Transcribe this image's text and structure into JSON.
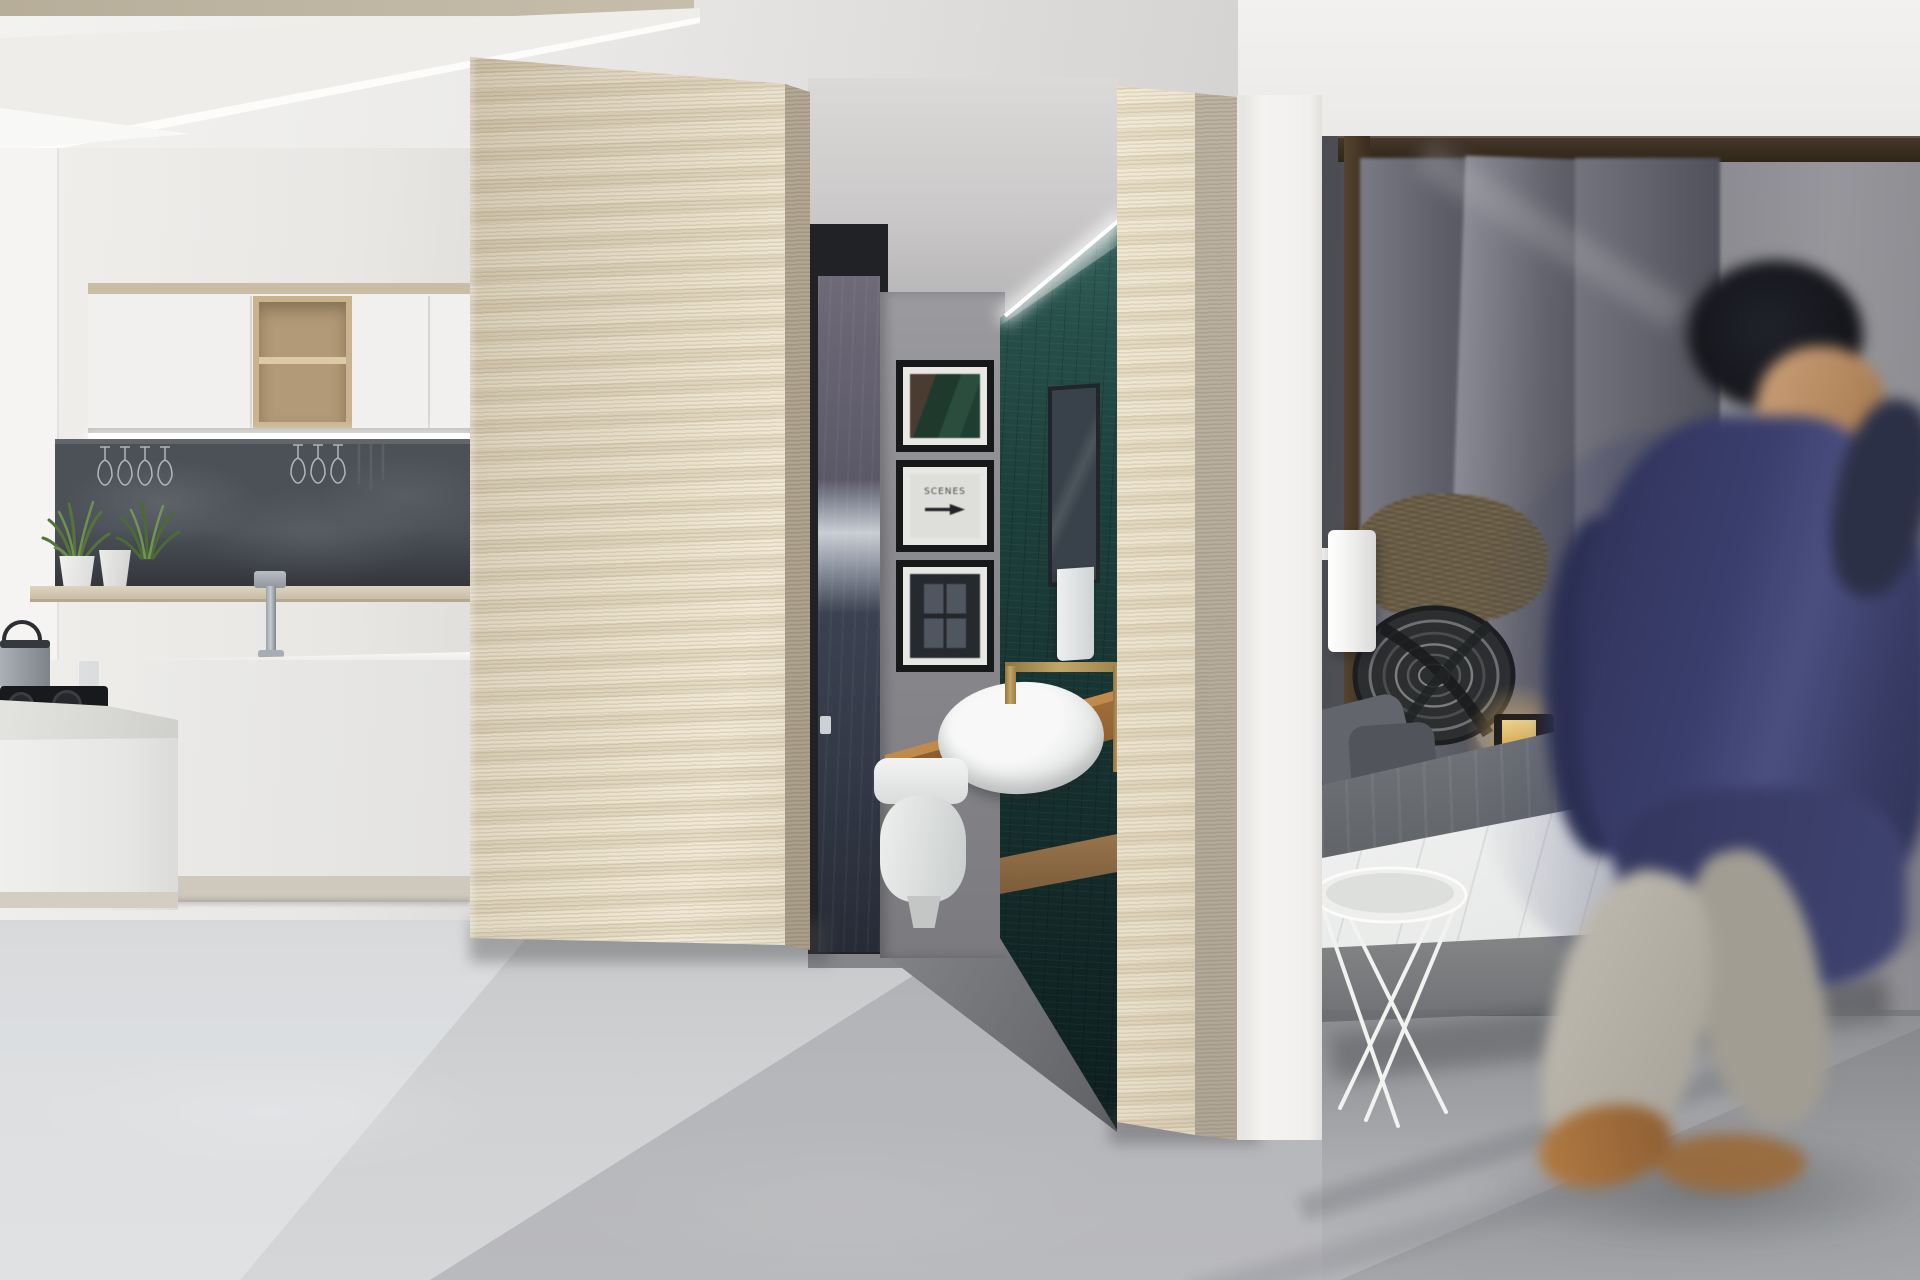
{
  "scene": {
    "title": "Studio apartment interior render",
    "style": "photorealistic 3D architectural visualization",
    "regions": [
      "kitchen",
      "travertine partition column",
      "bathroom niche",
      "second partition column",
      "bedroom",
      "walking person"
    ]
  },
  "kitchen": {
    "upper_cabinets": "white flat-front cabinets with open oak cube shelf",
    "backsplash": "dark slate niche with hanging stemware and LED under-cabinet light",
    "items": [
      "potted plant in white pot",
      "potted plant in white pot",
      "chrome faucet",
      "gas cooktop",
      "steel pot with lid",
      "glass tumbler",
      "white island",
      "white counter run"
    ]
  },
  "bathroom": {
    "artworks": [
      {
        "name": "framed-art-landscape",
        "desc": "dark green abstract landscape print",
        "text": ""
      },
      {
        "name": "framed-art-typographic",
        "text": "SCENES",
        "desc": "white print with black right arrow"
      },
      {
        "name": "framed-art-window",
        "desc": "dark window scene print",
        "text": ""
      }
    ],
    "fixtures": [
      "white round vessel sink",
      "brass square-arch faucet",
      "oak floating counter",
      "white toilet",
      "tiled mirror",
      "white hand towel",
      "dark glass door with chrome handle"
    ],
    "feature_wall": "dark teal mosaic tile with LED cove lighting"
  },
  "bedroom": {
    "furniture": [
      "dark wood four-poster frame",
      "gray drapes",
      "rattan headboard tray",
      "fur cushion",
      "white cylinder wall sconce",
      "glowing lantern candle",
      "white wire side table",
      "gray upholstered platform bed",
      "rounded gray footboard"
    ],
    "bedding": [
      "white duvet",
      "gray throw blanket",
      "dark gray pillows",
      "gray side pillow"
    ]
  },
  "person": {
    "desc": "motion-blurred man walking right while holding phone to ear",
    "clothing": {
      "jacket": "navy blue",
      "trousers": "light beige",
      "shoes": "tan"
    }
  },
  "palette": {
    "ceiling": "#f2f1ef",
    "floor": "#c9cbcd",
    "travertine_wood": "#e6dcc5",
    "slate_backsplash": "#4c5158",
    "teal_tile": "#173331",
    "oak_counter": "#a4703a",
    "brass": "#c3a567",
    "jacket_navy": "#3a3e6c",
    "wall_gray": "#8a8a90",
    "led_white": "#ffffff"
  }
}
